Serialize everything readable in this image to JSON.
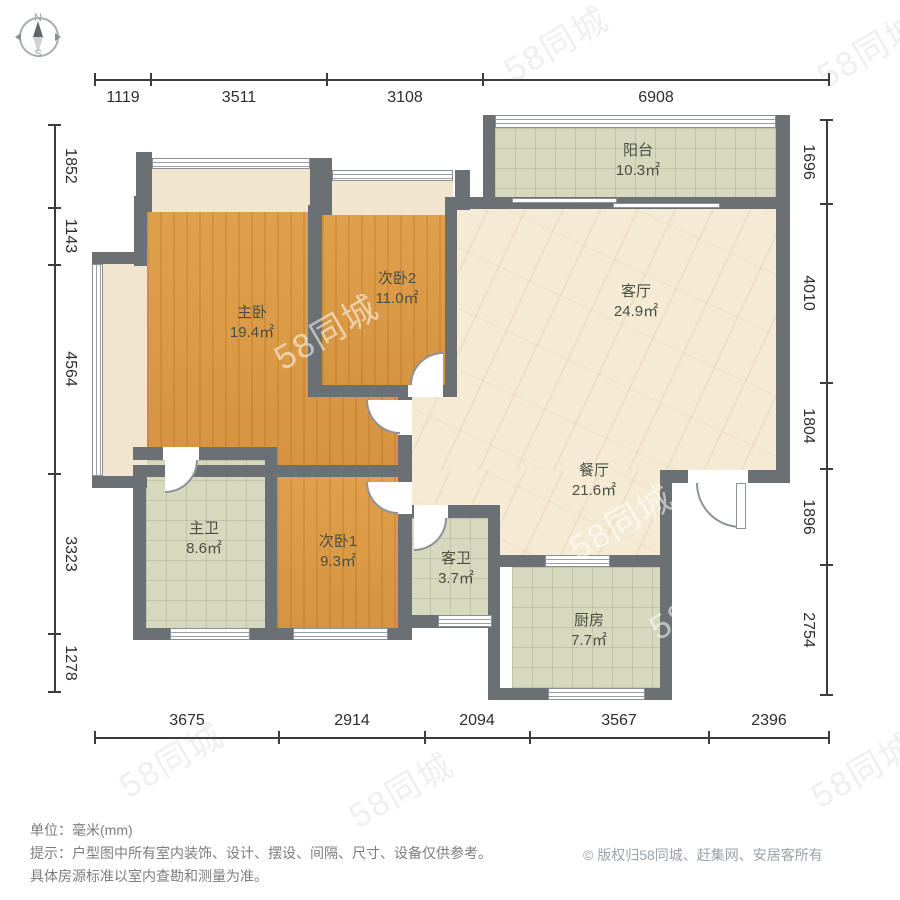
{
  "compass": {
    "north": "N",
    "south": "S"
  },
  "dimensions": {
    "top": [
      "1119",
      "3511",
      "3108",
      "6908"
    ],
    "bottom": [
      "3675",
      "2914",
      "2094",
      "3567",
      "2396"
    ],
    "left": [
      "1852",
      "1143",
      "4564",
      "3323",
      "1278"
    ],
    "right": [
      "1696",
      "4010",
      "1804",
      "1896",
      "2754"
    ]
  },
  "rooms": [
    {
      "name": "阳台",
      "area": "10.3㎡"
    },
    {
      "name": "客厅",
      "area": "24.9㎡"
    },
    {
      "name": "餐厅",
      "area": "21.6㎡"
    },
    {
      "name": "主卧",
      "area": "19.4㎡"
    },
    {
      "name": "次卧2",
      "area": "11.0㎡"
    },
    {
      "name": "次卧1",
      "area": "9.3㎡"
    },
    {
      "name": "主卫",
      "area": "8.6㎡"
    },
    {
      "name": "客卫",
      "area": "3.7㎡"
    },
    {
      "name": "厨房",
      "area": "7.7㎡"
    }
  ],
  "watermark": {
    "text": "58同城"
  },
  "footer": {
    "unit_line": "单位：毫米(mm)",
    "tip_line1": "提示：户型图中所有室内装饰、设计、摆设、间隔、尺寸、设备仅供参考。",
    "tip_line2": "具体房源标准以室内查勘和测量为准。",
    "copyright_symbol": "©",
    "copyright_text": "版权归58同城、赶集网、安居客所有"
  },
  "colors": {
    "wall": "#6b7075",
    "wood": "#dd9c44",
    "tile": "#d6d9bd",
    "marble": "#f5ebd5",
    "bay_window": "#f1e5d0",
    "dimension_text": "#2e2e2e",
    "label_text": "#4a4f45",
    "footer_text": "#7d7d7d",
    "copyright_text": "#9aa2aa"
  }
}
